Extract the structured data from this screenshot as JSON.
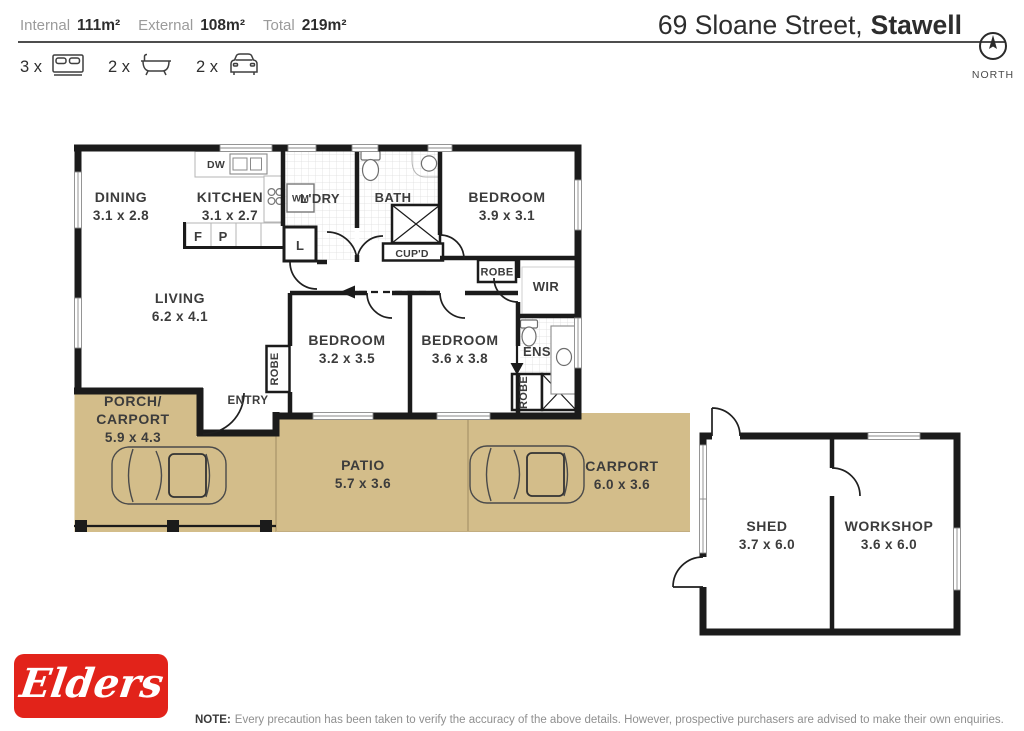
{
  "header": {
    "stats": {
      "internal_label": "Internal",
      "internal_value": "111m²",
      "external_label": "External",
      "external_value": "108m²",
      "total_label": "Total",
      "total_value": "219m²"
    },
    "address": {
      "street": "69 Sloane Street,",
      "suburb": "Stawell"
    },
    "compass": {
      "label": "NORTH"
    },
    "features": {
      "beds_count": "3 x",
      "baths_count": "2 x",
      "cars_count": "2 x"
    }
  },
  "floorplan": {
    "rooms": {
      "dining": {
        "name": "DINING",
        "dims": "3.1 x 2.8"
      },
      "kitchen": {
        "name": "KITCHEN",
        "dims": "3.1 x 2.7"
      },
      "laundry": {
        "name": "L'DRY"
      },
      "bath": {
        "name": "BATH"
      },
      "bed1": {
        "name": "BEDROOM",
        "dims": "3.9 x 3.1"
      },
      "living": {
        "name": "LIVING",
        "dims": "6.2 x 4.1"
      },
      "bed2": {
        "name": "BEDROOM",
        "dims": "3.2 x 3.5"
      },
      "bed3": {
        "name": "BEDROOM",
        "dims": "3.6 x 3.8"
      },
      "porch": {
        "name1": "PORCH/",
        "name2": "CARPORT",
        "dims": "5.9 x 4.3"
      },
      "patio": {
        "name": "PATIO",
        "dims": "5.7 x 3.6"
      },
      "carport": {
        "name": "CARPORT",
        "dims": "6.0 x 3.6"
      },
      "shed": {
        "name": "SHED",
        "dims": "3.7 x 6.0"
      },
      "workshop": {
        "name": "WORKSHOP",
        "dims": "3.6 x 6.0"
      }
    },
    "labels": {
      "entry": "ENTRY",
      "cupboard": "CUP'D",
      "robe1": "ROBE",
      "robe2": "ROBE",
      "robe3": "ROBE",
      "wir": "WIR",
      "ens": "ENS",
      "wm": "WM",
      "dw": "DW",
      "linen": "L",
      "fridge": "F",
      "pantry": "P"
    },
    "colors": {
      "outdoor": "#d3bd8a",
      "wall": "#1b1b1b"
    }
  },
  "footer": {
    "logo_text": "Elders",
    "note_label": "NOTE:",
    "note_text": "Every precaution has been taken to verify the accuracy of the above details. However, prospective purchasers are advised to make their own enquiries."
  }
}
